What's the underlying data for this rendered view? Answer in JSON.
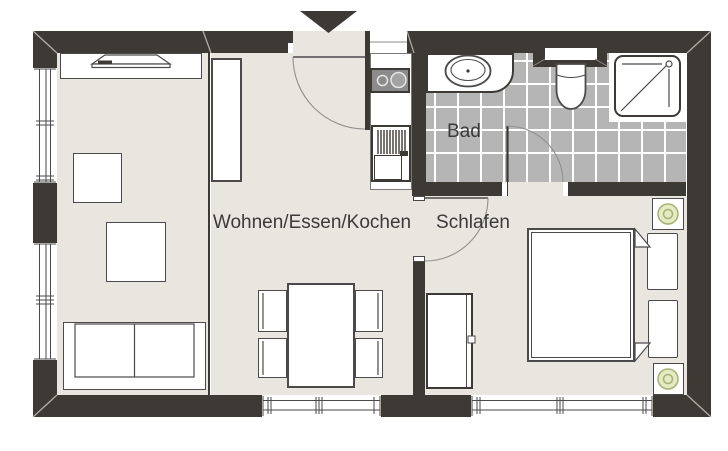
{
  "floorplan": {
    "rooms": [
      {
        "id": "living_dining_kitchen",
        "label": "Wohnen/Essen/Kochen"
      },
      {
        "id": "bathroom",
        "label": "Bad"
      },
      {
        "id": "bedroom",
        "label": "Schlafen"
      }
    ],
    "entrance_marker": "triangle-down",
    "fixtures": [
      "tv-sideboard",
      "tall-cabinet",
      "side-table",
      "coffee-table",
      "sofa",
      "dining-table",
      "dining-chair",
      "kitchen-counter",
      "cooktop",
      "kitchen-sink",
      "washbasin",
      "toilet",
      "shower",
      "double-bed",
      "pillow",
      "duvet-fold",
      "wardrobe",
      "plant-stool",
      "window",
      "door-swing"
    ],
    "colors": {
      "wall": "#3d3934",
      "floor": "#e9e6df",
      "tile": "#b5b5b5",
      "grout": "#ffffff",
      "line": "#4a4a4a",
      "softline": "#8a8a8a",
      "miter": "#b8b2a8",
      "green_fill": "#e5eac3",
      "green_stroke": "#a6b274",
      "cooktop": "#8b8b8b",
      "label": "#3a3a3a",
      "white": "#ffffff",
      "bg": "#ffffff"
    }
  }
}
